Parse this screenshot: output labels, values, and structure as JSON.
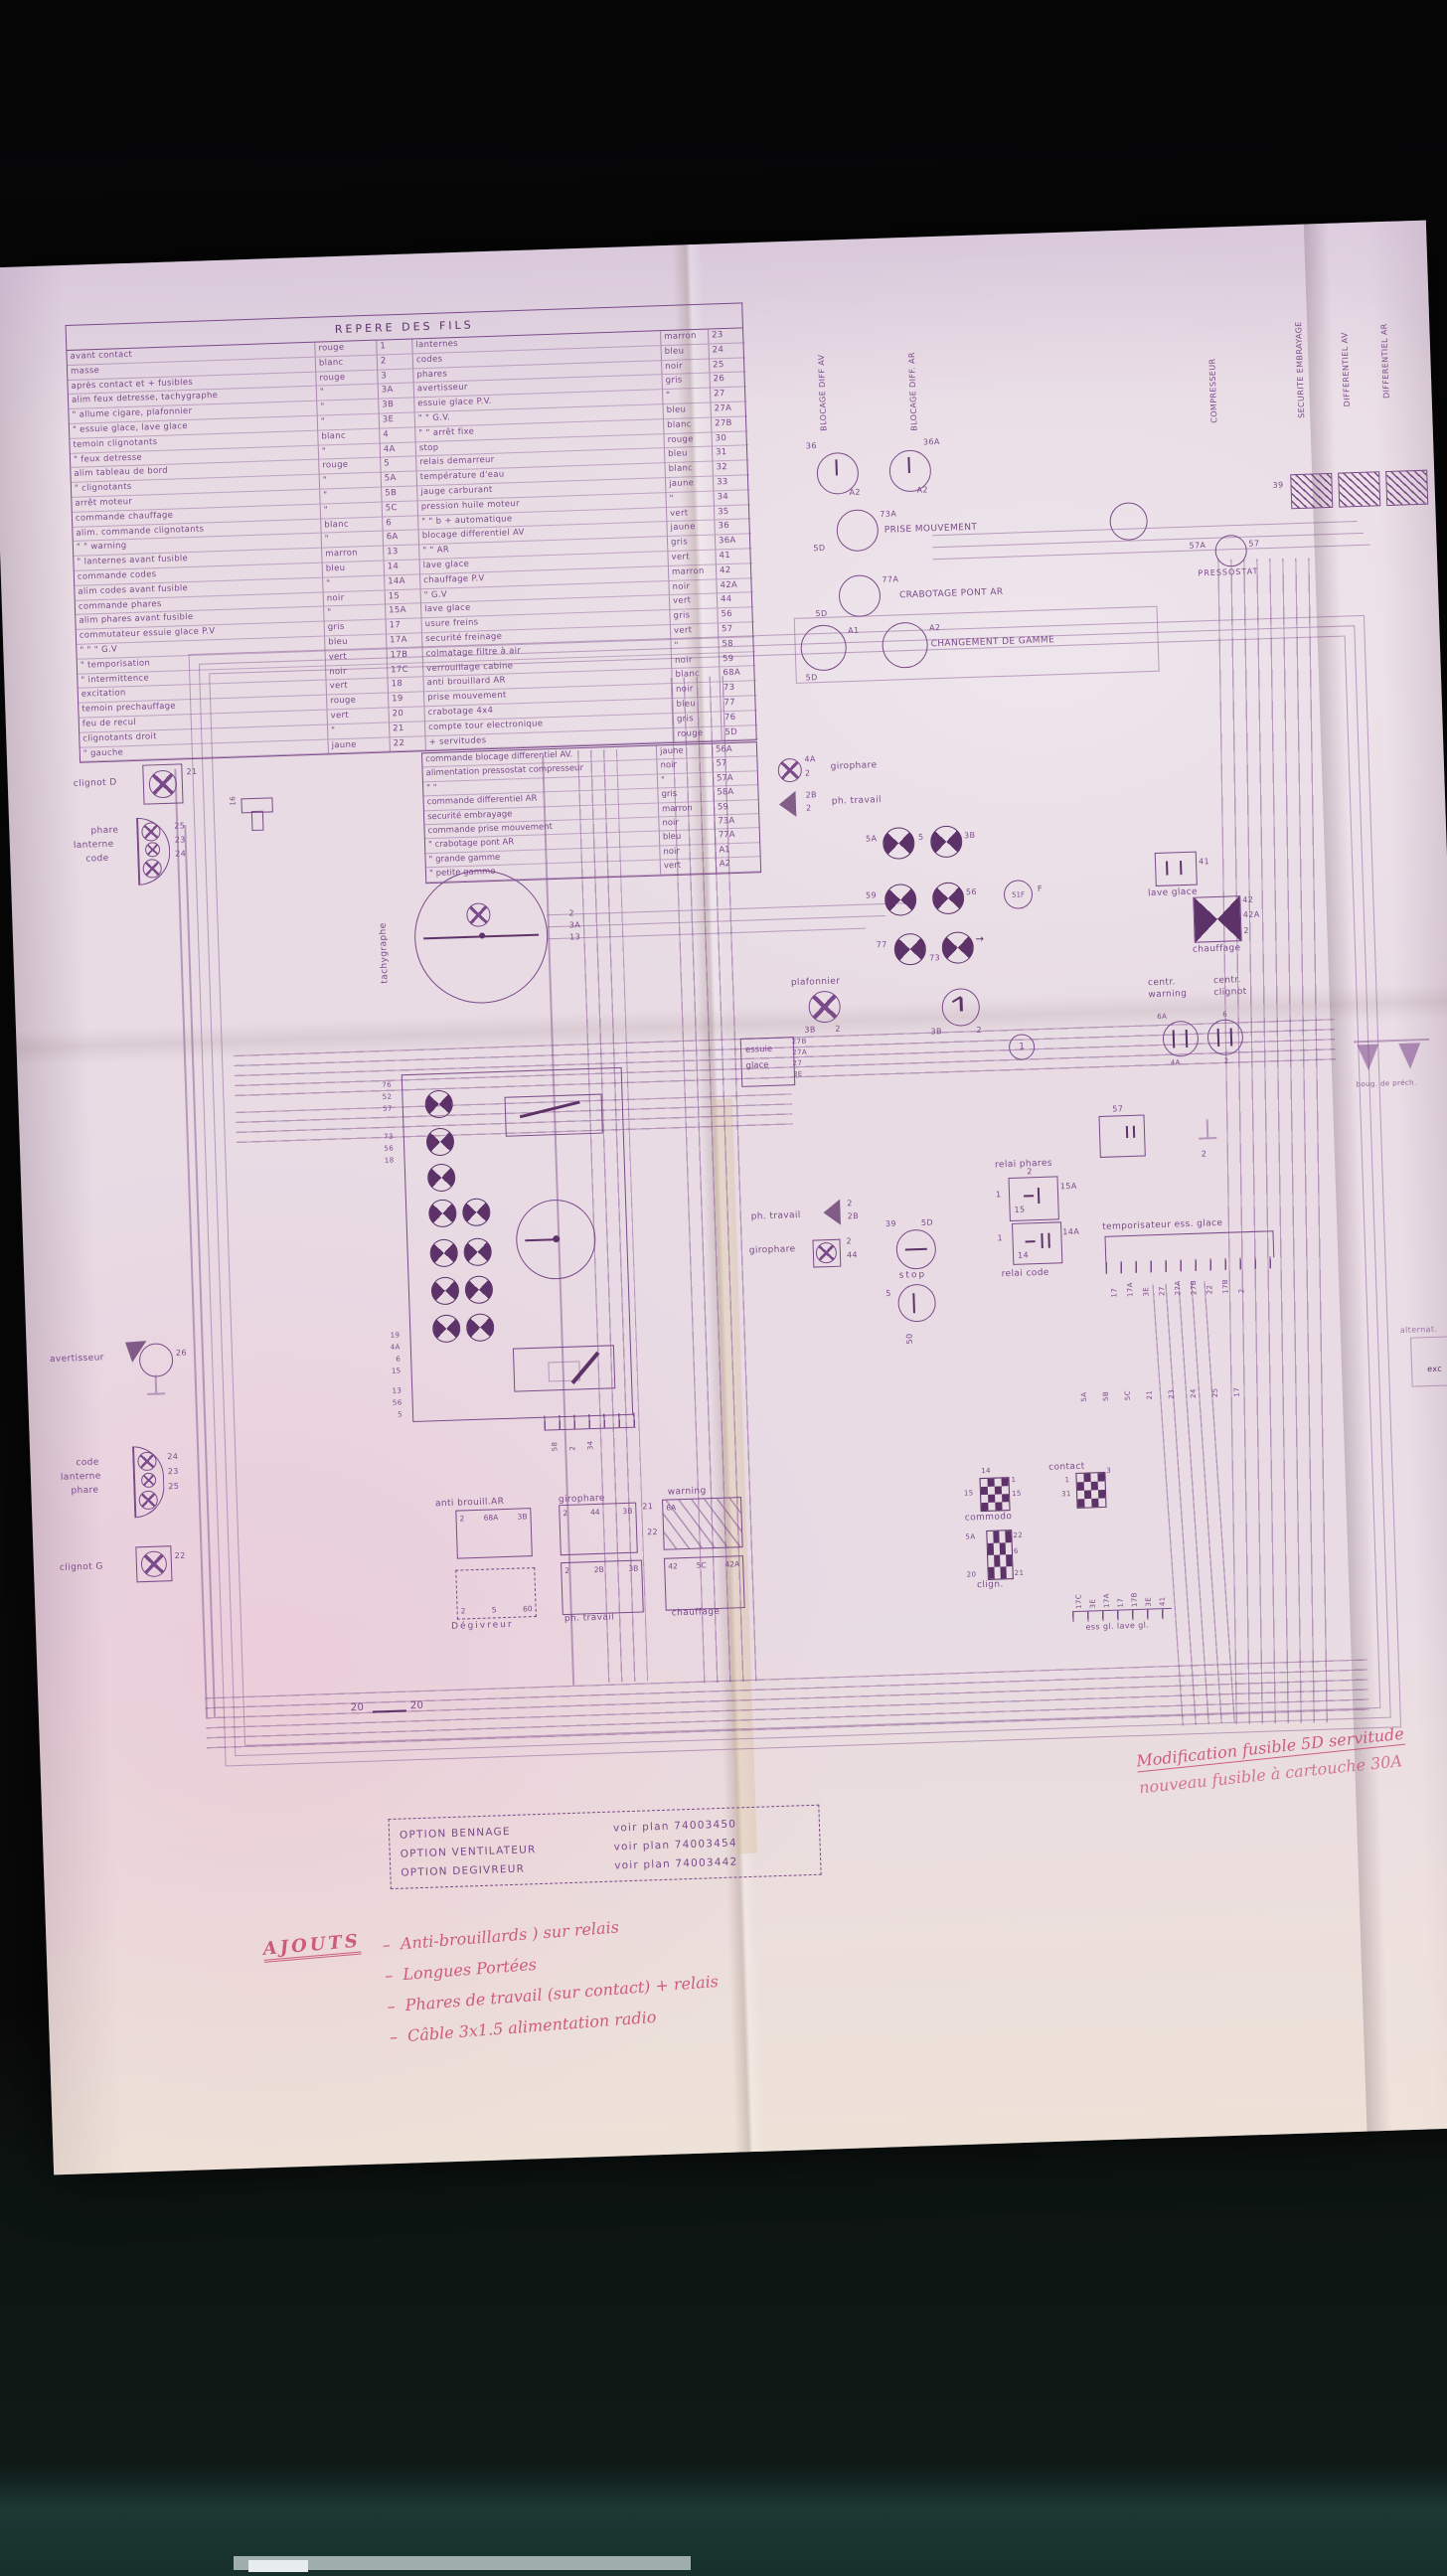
{
  "table": {
    "title": "REPERE DES FILS",
    "rows": [
      {
        "l": "avant contact",
        "lc": "rouge",
        "ln": "1",
        "r": "lanternes",
        "rc": "marron",
        "rn": "23"
      },
      {
        "l": "masse",
        "lc": "blanc",
        "ln": "2",
        "r": "codes",
        "rc": "bleu",
        "rn": "24"
      },
      {
        "l": "après contact et + fusibles",
        "lc": "rouge",
        "ln": "3",
        "r": "phares",
        "rc": "noir",
        "rn": "25"
      },
      {
        "l": "alim feux detresse, tachygraphe",
        "lc": "\"",
        "ln": "3A",
        "r": "avertisseur",
        "rc": "gris",
        "rn": "26"
      },
      {
        "l": "\"  allume cigare, plafonnier",
        "lc": "\"",
        "ln": "3B",
        "r": "essuie glace  P.V.",
        "rc": "\"",
        "rn": "27"
      },
      {
        "l": "\"  essuie glace, lave glace",
        "lc": "\"",
        "ln": "3E",
        "r": "\"      \"      G.V.",
        "rc": "bleu",
        "rn": "27A"
      },
      {
        "l": "temoin clignotants",
        "lc": "blanc",
        "ln": "4",
        "r": "\"      \"      arrêt fixe",
        "rc": "blanc",
        "rn": "27B"
      },
      {
        "l": "\"    feux detresse",
        "lc": "\"",
        "ln": "4A",
        "r": "stop",
        "rc": "rouge",
        "rn": "30"
      },
      {
        "l": "alim tableau de bord",
        "lc": "rouge",
        "ln": "5",
        "r": "relais demarreur",
        "rc": "bleu",
        "rn": "31"
      },
      {
        "l": "\"    clignotants",
        "lc": "\"",
        "ln": "5A",
        "r": "température d'eau",
        "rc": "blanc",
        "rn": "32"
      },
      {
        "l": "arrêt moteur",
        "lc": "\"",
        "ln": "5B",
        "r": "jauge carburant",
        "rc": "jaune",
        "rn": "33"
      },
      {
        "l": "commande chauffage",
        "lc": "\"",
        "ln": "5C",
        "r": "pression huile moteur",
        "rc": "\"",
        "rn": "34"
      },
      {
        "l": "alim. commande clignotants",
        "lc": "blanc",
        "ln": "6",
        "r": "\"    \"    b + automatique",
        "rc": "vert",
        "rn": "35"
      },
      {
        "l": "\"      \"      warning",
        "lc": "\"",
        "ln": "6A",
        "r": "blocage differentiel AV",
        "rc": "jaune",
        "rn": "36"
      },
      {
        "l": "\"  lanternes avant fusible",
        "lc": "marron",
        "ln": "13",
        "r": "\"        \"        AR",
        "rc": "gris",
        "rn": "36A"
      },
      {
        "l": "commande codes",
        "lc": "bleu",
        "ln": "14",
        "r": "lave glace",
        "rc": "vert",
        "rn": "41"
      },
      {
        "l": "alim codes avant fusible",
        "lc": "\"",
        "ln": "14A",
        "r": "chauffage   P.V",
        "rc": "marron",
        "rn": "42"
      },
      {
        "l": "commande phares",
        "lc": "noir",
        "ln": "15",
        "r": "\"            G.V",
        "rc": "noir",
        "rn": "42A"
      },
      {
        "l": "alim phares avant fusible",
        "lc": "\"",
        "ln": "15A",
        "r": "lave glace",
        "rc": "vert",
        "rn": "44"
      },
      {
        "l": "commutateur essuie glace  P.V",
        "lc": "gris",
        "ln": "17",
        "r": "usure freins",
        "rc": "gris",
        "rn": "56"
      },
      {
        "l": "\"        \"        \"    G.V",
        "lc": "bleu",
        "ln": "17A",
        "r": "securité freinage",
        "rc": "vert",
        "rn": "57"
      },
      {
        "l": "\"        temporisation",
        "lc": "vert",
        "ln": "17B",
        "r": "colmatage filtre à air",
        "rc": "\"",
        "rn": "58"
      },
      {
        "l": "\"        intermittence",
        "lc": "noir",
        "ln": "17C",
        "r": "verrouillage cabine",
        "rc": "noir",
        "rn": "59"
      },
      {
        "l": "excitation",
        "lc": "vert",
        "ln": "18",
        "r": "anti brouillard AR",
        "rc": "blanc",
        "rn": "68A"
      },
      {
        "l": "temoin  prechauffage",
        "lc": "rouge",
        "ln": "19",
        "r": "prise mouvement",
        "rc": "noir",
        "rn": "73"
      },
      {
        "l": "feu de recul",
        "lc": "vert",
        "ln": "20",
        "r": "crabotage  4x4",
        "rc": "bleu",
        "rn": "77"
      },
      {
        "l": "clignotants droit",
        "lc": "\"",
        "ln": "21",
        "r": "compte tour electronique",
        "rc": "gris",
        "rn": "76"
      },
      {
        "l": "\"        gauche",
        "lc": "jaune",
        "ln": "22",
        "r": "+ servitudes",
        "rc": "rouge",
        "rn": "5D"
      }
    ],
    "extra": [
      {
        "l": "commande blocage differentiel AV.",
        "c": "jaune",
        "n": "56A"
      },
      {
        "l": "alimentation pressostat compresseur",
        "c": "noir",
        "n": "57"
      },
      {
        "l": "\"            \"",
        "c": "\"",
        "n": "57A"
      },
      {
        "l": "commande differentiel AR",
        "c": "gris",
        "n": "58A"
      },
      {
        "l": "securité embrayage",
        "c": "marron",
        "n": "59"
      },
      {
        "l": "commande  prise mouvement",
        "c": "noir",
        "n": "73A"
      },
      {
        "l": "\"    crabotage pont AR",
        "c": "bleu",
        "n": "77A"
      },
      {
        "l": "\"    grande gamme",
        "c": "noir",
        "n": "A1"
      },
      {
        "l": "\"    petite gamme",
        "c": "vert",
        "n": "A2"
      }
    ]
  },
  "side_labels": {
    "blocage_av": "BLOCAGE DIFF AV",
    "blocage_ar": "BLOCAGE DIFF. AR",
    "compresseur": "COMPRESSEUR",
    "securite_embrayage": "SECURITE EMBRAYAGE",
    "differentiel_av": "DIFFERENTIEL AV",
    "differentiel_ar": "DIFFERENTIEL AR"
  },
  "right_units": {
    "prise_mouvement": "PRISE MOUVEMENT",
    "crabotage": "CRABOTAGE  PONT AR",
    "changement": "CHANGEMENT  DE  GAMME",
    "pressostat": "PRESSOSTAT",
    "p73a": "73A",
    "p77a": "77A",
    "p5d": "5D",
    "pa1": "A1",
    "pa2": "A2",
    "p36": "36",
    "p36a": "36A",
    "p57": "57",
    "p57a": "57A",
    "p39": "39",
    "bougies": "boug. de préch.",
    "alternateur": "alternat.",
    "exc": "exc"
  },
  "left_units": {
    "clignot_d": "clignot D",
    "p21": "21",
    "fuse": "16",
    "phare": [
      "phare",
      "lanterne",
      "code"
    ],
    "p25": "25",
    "p23": "23",
    "p24": "24",
    "avertisseur": "avertisseur",
    "p26": "26",
    "code_lph": [
      "code",
      "lanterne",
      "phare"
    ],
    "clignot_g": "clignot G",
    "p22": "22"
  },
  "tachy": {
    "label": "tachygraphe",
    "pins": [
      "2",
      "3A",
      "13"
    ]
  },
  "cluster": {
    "pins_g1": [
      "76",
      "52",
      "57"
    ],
    "pins_g2": [
      "73",
      "56",
      "18"
    ],
    "pins_g3": [
      "19",
      "4A",
      "6",
      "15"
    ],
    "pins_g4": [
      "13",
      "56",
      "5"
    ],
    "pins_bottom": [
      "58",
      "2",
      "34"
    ]
  },
  "mid": {
    "girophare": "girophare",
    "ph_travail": "ph. travail",
    "p4a": "4A",
    "p2": "2",
    "p2b": "2B",
    "plafonnier": "plafonnier",
    "p3b": "3B",
    "essuie": [
      "essuie",
      "glace"
    ],
    "ess_pins": [
      "27B",
      "27A",
      "27",
      "3E"
    ],
    "clock_pins": [
      "3B",
      "2"
    ],
    "one": "1",
    "r1": [
      "5A",
      "5",
      "3B"
    ],
    "r2": [
      "59",
      "56",
      "51F",
      "F"
    ],
    "r3": [
      "77",
      "73",
      "→"
    ],
    "lave_glace": "lave glace",
    "p41": "41",
    "chauffage": "chauffage",
    "chauff_pins": [
      "42",
      "42A",
      "2"
    ],
    "centr_warning": "centr. warning",
    "centr_clignot": "centr. clignot",
    "cw_pins": [
      "6A",
      "4A",
      "6",
      "2"
    ],
    "relai_phares": "relai phares",
    "rp_pins": [
      "2",
      "1",
      "15A",
      "15"
    ],
    "relai_code": "relai code",
    "rc_pins": [
      "1",
      "14A",
      "14"
    ],
    "r57": "57",
    "gnd2": "2",
    "tempo": "temporisateur ess. glace",
    "tempo_pins": [
      "17",
      "17A",
      "3E",
      "27",
      "27A",
      "27B",
      "22",
      "17B",
      "2"
    ],
    "stop": "stop",
    "p5": "5",
    "p50": "50",
    "p39": "39",
    "p5d": "5D",
    "p44": "44"
  },
  "switches": {
    "s1": {
      "label": "anti brouill.AR",
      "pins": [
        "2",
        "68A",
        "3B"
      ]
    },
    "s2": {
      "label": "girophare",
      "pins": [
        "2",
        "44",
        "3B"
      ]
    },
    "s3": {
      "label": "warning",
      "pins": [
        "6A",
        "",
        ""
      ]
    },
    "s4": {
      "label": "Dégivreur",
      "pins": [
        "2",
        "5",
        "60"
      ]
    },
    "s5": {
      "label": "ph. travail",
      "pins": [
        "2",
        "2B",
        "3B"
      ]
    },
    "s6": {
      "label": "chauffage",
      "pins": [
        "42",
        "5C",
        "42A"
      ]
    },
    "w21": "21",
    "w22": "22"
  },
  "conn": {
    "commodo": {
      "label": "commodo",
      "pins": [
        "14",
        "1",
        "15",
        "15"
      ]
    },
    "contact": {
      "label": "contact",
      "pins": [
        "1",
        "31",
        "3"
      ]
    },
    "clign": {
      "label": "clign.",
      "pins": [
        "5A",
        "22",
        "6",
        "20",
        "21"
      ]
    },
    "essgl": {
      "label": "ess gl.  lave gl.",
      "pins": [
        "17C",
        "3E",
        "17A",
        "17",
        "17B",
        "3E",
        "41"
      ]
    },
    "strip": [
      "5A",
      "5B",
      "5C",
      "21",
      "23",
      "24",
      "25",
      "17"
    ]
  },
  "misc": {
    "p20": "20"
  },
  "options": {
    "rows": [
      {
        "name": "OPTION  BENNAGE",
        "plan": "voir plan  74003450"
      },
      {
        "name": "OPTION  VENTILATEUR",
        "plan": "voir plan  74003454"
      },
      {
        "name": "OPTION  DEGIVREUR",
        "plan": "voir plan  74003442"
      }
    ]
  },
  "notes": {
    "modif1": "Modification fusible 5D servitude",
    "modif2": "nouveau fusible à cartouche 30A",
    "ajouts": "AJOUTS",
    "items": [
      "Anti-brouillards  ) sur relais",
      "Longues Portées",
      "Phares de travail  (sur contact) + relais",
      "Câble 3x1.5 alimentation radio"
    ]
  },
  "colors": {
    "ink": "#7b4a8a",
    "red": "#c94a72",
    "paper": "#e8dbe4"
  }
}
